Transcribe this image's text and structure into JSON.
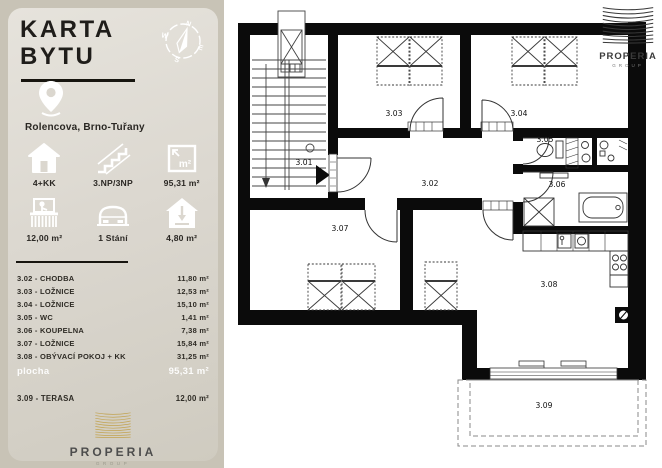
{
  "sidebar": {
    "title_lines": [
      "KARTA",
      "BYTU"
    ],
    "location": "Rolencova, Brno-Tuřany",
    "stats": [
      {
        "icon": "house-icon",
        "value": "4+KK"
      },
      {
        "icon": "stairs-icon",
        "value": "3.NP/3NP"
      },
      {
        "icon": "area-icon",
        "value": "95,31 m²"
      },
      {
        "icon": "balcony-icon",
        "value": "12,00 m²"
      },
      {
        "icon": "parking-icon",
        "value": "1 Stání"
      },
      {
        "icon": "cellar-icon",
        "value": "4,80 m²"
      }
    ],
    "rooms": [
      {
        "label": "3.02 - CHODBA",
        "area": "11,80 m²"
      },
      {
        "label": "3.03 - LOŽNICE",
        "area": "12,53 m²"
      },
      {
        "label": "3.04 - LOŽNICE",
        "area": "15,10 m²"
      },
      {
        "label": "3.05 - WC",
        "area": "1,41 m²"
      },
      {
        "label": "3.06 - KOUPELNA",
        "area": "7,38 m²"
      },
      {
        "label": "3.07 - LOŽNICE",
        "area": "15,84 m²"
      },
      {
        "label": "3.08 - OBÝVACÍ POKOJ + KK",
        "area": "31,25 m²"
      }
    ],
    "total": {
      "label": "plocha",
      "value": "95,31 m²"
    },
    "terrace": {
      "label": "3.09 - TERASA",
      "area": "12,00 m²"
    },
    "brand": {
      "name": "PROPERIA",
      "group": "GROUP"
    }
  },
  "plan": {
    "labels": {
      "r301": "3.01",
      "r302": "3.02",
      "r303": "3.03",
      "r304": "3.04",
      "r305": "3.05",
      "r306": "3.06",
      "r307": "3.07",
      "r308": "3.08",
      "r309": "3.09"
    },
    "watermark": {
      "name": "PROPERIA",
      "group": "GROUP"
    }
  },
  "colors": {
    "card_bg": "#dbd7cf",
    "backdrop": "#c8c3b6",
    "brand_gold": "#c2a350",
    "wall": "#0b0b0b"
  }
}
